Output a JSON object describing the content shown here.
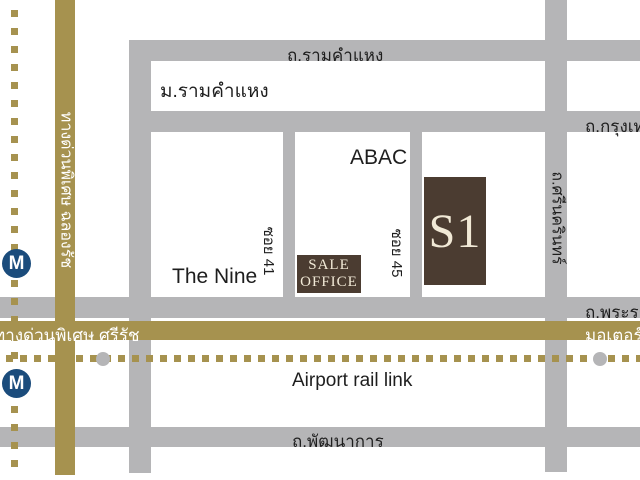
{
  "map": {
    "project_badge": "S1",
    "sale_office": {
      "line1": "SALE",
      "line2": "OFFICE"
    },
    "metro_icon": "M",
    "labels": {
      "ramkhamhaeng_road": "ถ.รามคำแหง",
      "ramkhamhaeng_university": "ม.รามคำแหง",
      "krungthep_kreetha_road": "ถ.กรุงเทพกรีฑา",
      "srinagarindra_road": "ถ.ศรีนครินทร์",
      "soi_41": "ซอย 41",
      "soi_45": "ซอย 45",
      "abac": "ABAC",
      "the_nine": "The Nine",
      "chalong_rat_expressway": "ทางด่วนพิเศษ ฉลองรัช",
      "si_rat_expressway": "ทางด่วนพิเศษ ศรีรัช",
      "motorway": "มอเตอร์เวย์",
      "rama9_road": "ถ.พระราม 9",
      "airport_rail_link": "Airport rail link",
      "phatthanakan_road": "ถ.พัฒนาการ"
    },
    "colors": {
      "road_gray": "#b5b5b7",
      "expressway_gold": "#a6924f",
      "building_brown": "#4b3c31",
      "cream_text": "#f1e9d6",
      "metro_navy": "#1b4c7c",
      "label_black": "#1e1e1e"
    }
  }
}
